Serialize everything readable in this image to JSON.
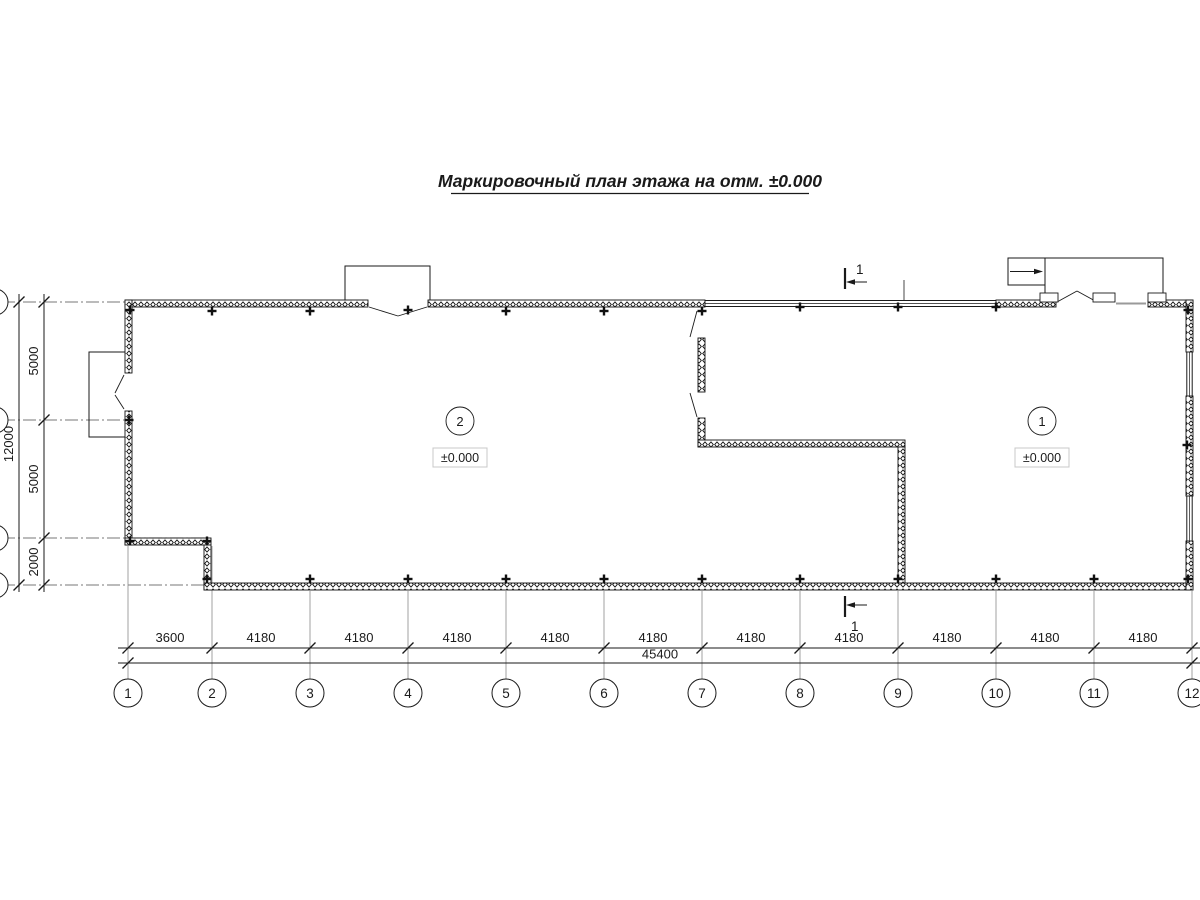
{
  "title": "Маркировочный план этажа на отм. ±0.000",
  "section_mark": {
    "label": "1"
  },
  "rooms": [
    {
      "number": "1",
      "elevation": "±0.000"
    },
    {
      "number": "2",
      "elevation": "±0.000"
    }
  ],
  "dimensions": {
    "bottom_segments": [
      "3600",
      "4180",
      "4180",
      "4180",
      "4180",
      "4180",
      "4180",
      "4180",
      "4180",
      "4180",
      "4180"
    ],
    "bottom_total": "45400",
    "left_segments": [
      "5000",
      "5000",
      "2000"
    ],
    "left_total": "12000"
  },
  "axes": {
    "bottom": [
      "1",
      "2",
      "3",
      "4",
      "5",
      "6",
      "7",
      "8",
      "9",
      "10",
      "11",
      "12"
    ]
  },
  "colors": {
    "line": "#1a1a1a",
    "extension": "#8a8a8a",
    "sill": "#9a9a9a",
    "elevation_box_border": "#c8c8c8"
  }
}
